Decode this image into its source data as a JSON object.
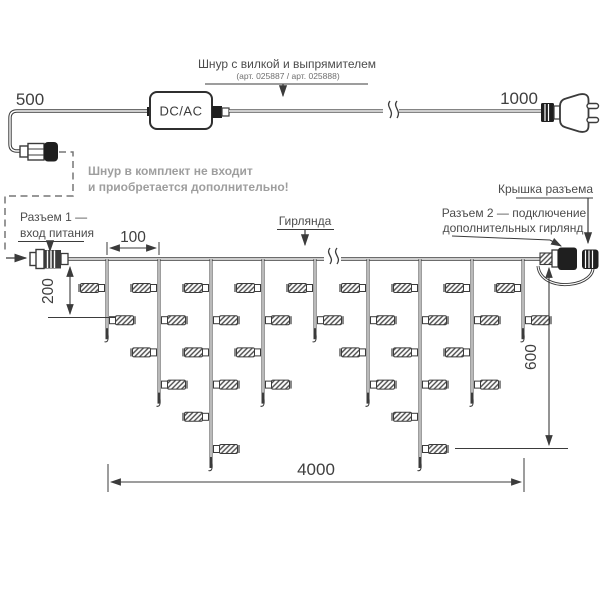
{
  "colors": {
    "stroke": "#3b3b3b",
    "text": "#4c4c4c",
    "note_gray": "#9e9e9e",
    "black_part": "#1f1f1f",
    "background": "#ffffff"
  },
  "top": {
    "dim_left": "500",
    "adapter_label": "DC/AC",
    "cord_label": "Шнур с вилкой и выпрямителем",
    "cord_art": "(арт. 025887 / арт. 025888)",
    "dim_right": "1000",
    "note_line1": "Шнур в комплект не входит",
    "note_line2": "и приобретается дополнительно!"
  },
  "garland": {
    "connector1_line1": "Разъем 1 —",
    "connector1_line2": "вход питания",
    "garland_label": "Гирлянда",
    "cap_label": "Крышка разъема",
    "connector2_line1": "Разъем 2 — подключение",
    "connector2_line2": "дополнительных гирлянд",
    "dims": {
      "spacing": "100",
      "short_drop": "200",
      "height": "600",
      "length": "4000"
    },
    "wire_y": 259,
    "lamp_first_row_y": 288,
    "lamp_row_step": 32.2,
    "drops": [
      {
        "x": 107,
        "lamps": 2
      },
      {
        "x": 159,
        "lamps": 4
      },
      {
        "x": 211,
        "lamps": 6
      },
      {
        "x": 263,
        "lamps": 4
      },
      {
        "x": 315,
        "lamps": 2
      },
      {
        "x": 368,
        "lamps": 4
      },
      {
        "x": 420,
        "lamps": 6
      },
      {
        "x": 472,
        "lamps": 4
      },
      {
        "x": 523,
        "lamps": 2
      }
    ]
  }
}
